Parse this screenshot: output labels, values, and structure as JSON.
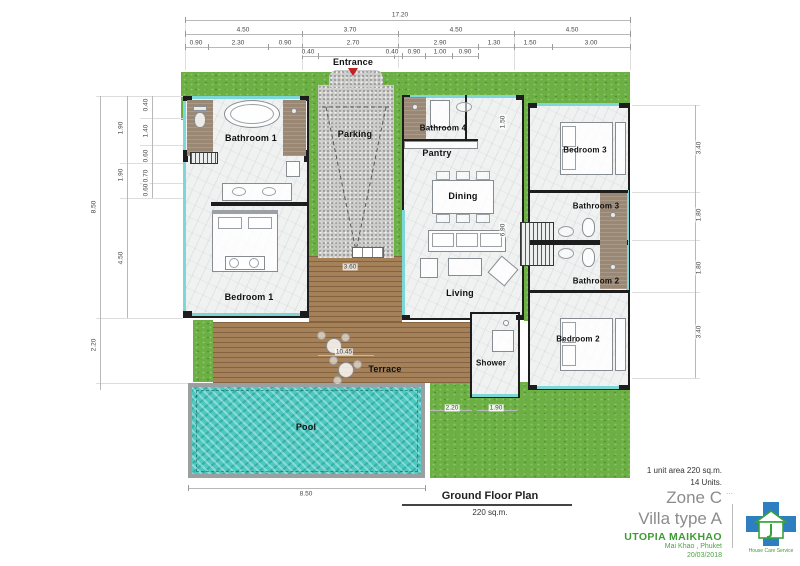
{
  "rooms": {
    "bathroom1": "Bathroom 1",
    "bedroom1": "Bedroom 1",
    "entrance": "Entrance",
    "parking": "Parking",
    "bathroom4": "Bathroom 4",
    "pantry": "Pantry",
    "dining": "Dining",
    "living": "Living",
    "bedroom3": "Bedroom 3",
    "bathroom3": "Bathroom 3",
    "bathroom2": "Bathroom 2",
    "bedroom2": "Bedroom 2",
    "shower": "Shower",
    "terrace": "Terrace",
    "pool": "Pool"
  },
  "dims": {
    "overall_width": "17.20",
    "top_row2": [
      "4.50",
      "3.70",
      "4.50",
      "4.50"
    ],
    "top_row3": [
      "0.90",
      "2.30",
      "0.90",
      "2.70",
      "2.90",
      "1.30",
      "1.50",
      "3.00"
    ],
    "top_row4": [
      "0.40",
      "0.40",
      "0.90",
      "1.00",
      "0.90"
    ],
    "left_outer": [
      "8.50",
      "2.20"
    ],
    "left_mid": [
      "1.90",
      "1.90",
      "4.50"
    ],
    "left_inner": [
      "0.40",
      "1.40",
      "0.60",
      "0.70",
      "0.60"
    ],
    "right": [
      "3.40",
      "1.80",
      "1.80",
      "3.40"
    ],
    "inner_vertical": [
      "1.50",
      "6.90"
    ],
    "deck_width": "10.45",
    "parking_width": "3.60",
    "pool_width": "8.50",
    "shower_dims": [
      "2.20",
      "1.90"
    ]
  },
  "footer": {
    "plan_title": "Ground Floor Plan",
    "plan_area": "220 sq.m."
  },
  "title_block": {
    "unit_area": "1 unit area 220 sq.m.",
    "units": "14 Units.",
    "zone": "Zone C",
    "marks": "⋯",
    "villa_type": "Villa type A",
    "project": "UTOPIA MAIKHAO",
    "location": "Mai Khao , Phuket",
    "date": "20/03/2018",
    "logo_caption": "House Care Service"
  },
  "colors": {
    "grass": "#6cb044",
    "pool_water": "#49c7bf",
    "deck_wood": "#a5815a",
    "glass_teal": "#7cd8d8",
    "brand_green": "#3f9c35",
    "title_gray": "#8c8c8c",
    "logo_blue": "#2d7fc1"
  }
}
